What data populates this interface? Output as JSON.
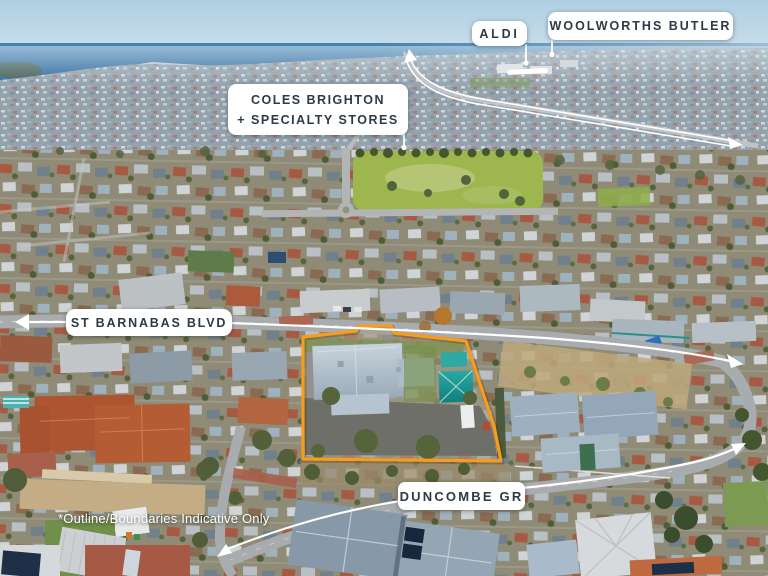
{
  "map_labels": {
    "aldi": "ALDI",
    "woolworths": "WOOLWORTHS BUTLER",
    "coles_line1": "COLES BRIGHTON",
    "coles_line2": "+ SPECIALTY STORES",
    "st_barnabas": "ST BARNABAS BLVD",
    "duncombe": "DUNCOMBE GR"
  },
  "disclaimer": "*Outline/Boundaries Indicative Only",
  "colors": {
    "property_outline": "#F79C1C",
    "label_background": "#FFFFFF",
    "label_text": "#2D3A47",
    "annotation_lines": "#FFFFFF"
  }
}
